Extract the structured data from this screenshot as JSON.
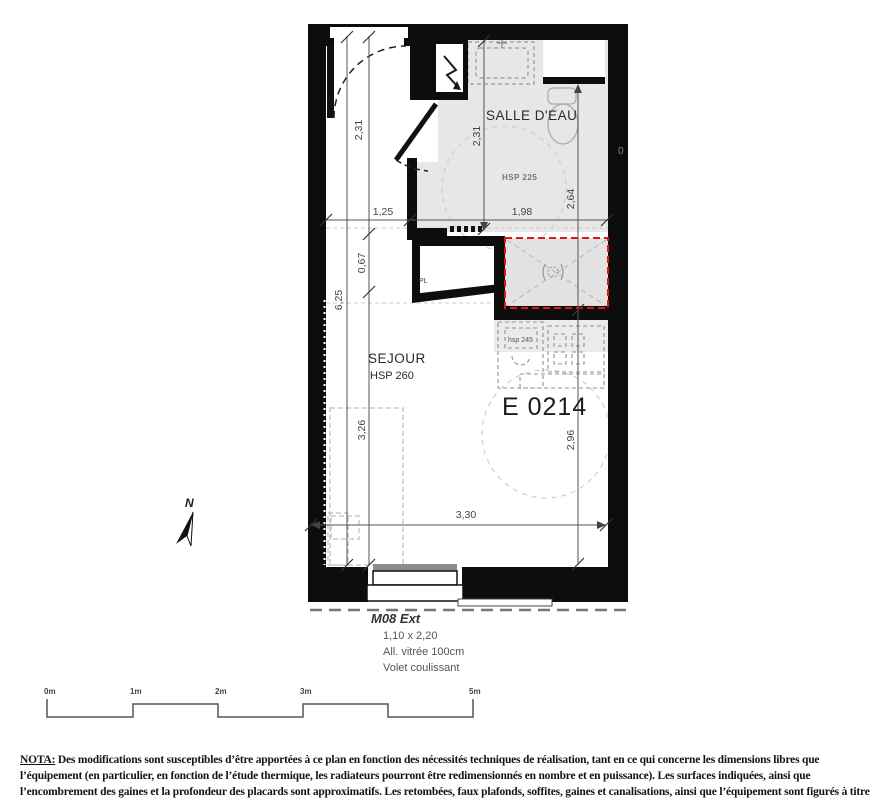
{
  "plan": {
    "unit_label": "E 0214",
    "rooms": {
      "salle_deau": {
        "name": "SALLE D'EAU",
        "hsp": "HSP 225"
      },
      "sejour": {
        "name": "SEJOUR",
        "hsp": "HSP 260"
      },
      "kitchen_hsp": "hsp 245",
      "closet": "PL"
    },
    "dimensions": {
      "left_outer": "6,25",
      "left_seg1": "2,31",
      "left_seg2": "0,67",
      "left_seg3": "3,26",
      "top_left": "1,25",
      "top_right": "1,98",
      "bath_height": "2,31",
      "right_upper": "2,64",
      "right_lower": "2,96",
      "bottom_width": "3,30"
    },
    "stray_zero": "0",
    "window": {
      "code": "M08 Ext",
      "size": "1,10 x 2,20",
      "glazing": "All. vitrée 100cm",
      "shutter": "Volet coulissant"
    },
    "compass": {
      "label": "N"
    }
  },
  "scalebar": {
    "labels": [
      "0m",
      "1m",
      "2m",
      "3m",
      "5m"
    ]
  },
  "nota": {
    "label": "NOTA:",
    "text": " Des modifications sont susceptibles d’être apportées à ce plan en fonction des nécessités techniques de réalisation, tant en ce qui concerne les dimensions libres que l’équipement (en particulier, en fonction de l’étude thermique, les radiateurs pourront être redimensionnés en nombre et en puissance). Les surfaces indiquées, ainsi que l’encombrement des gaines et la profondeur des placards sont approximatifs. Les retombées, faux plafonds, soffites, gaines et canalisations, ainsi que l’équipement sont figurés à titre indicatif. La surface globale peut varier de plus ou moins 5%"
  },
  "colors": {
    "wall": "#0d0d0d",
    "bath_floor": "#e7e7e7",
    "shower_fill": "#e2e2e2",
    "shower_border": "#e01616",
    "dim_line": "#555555"
  }
}
